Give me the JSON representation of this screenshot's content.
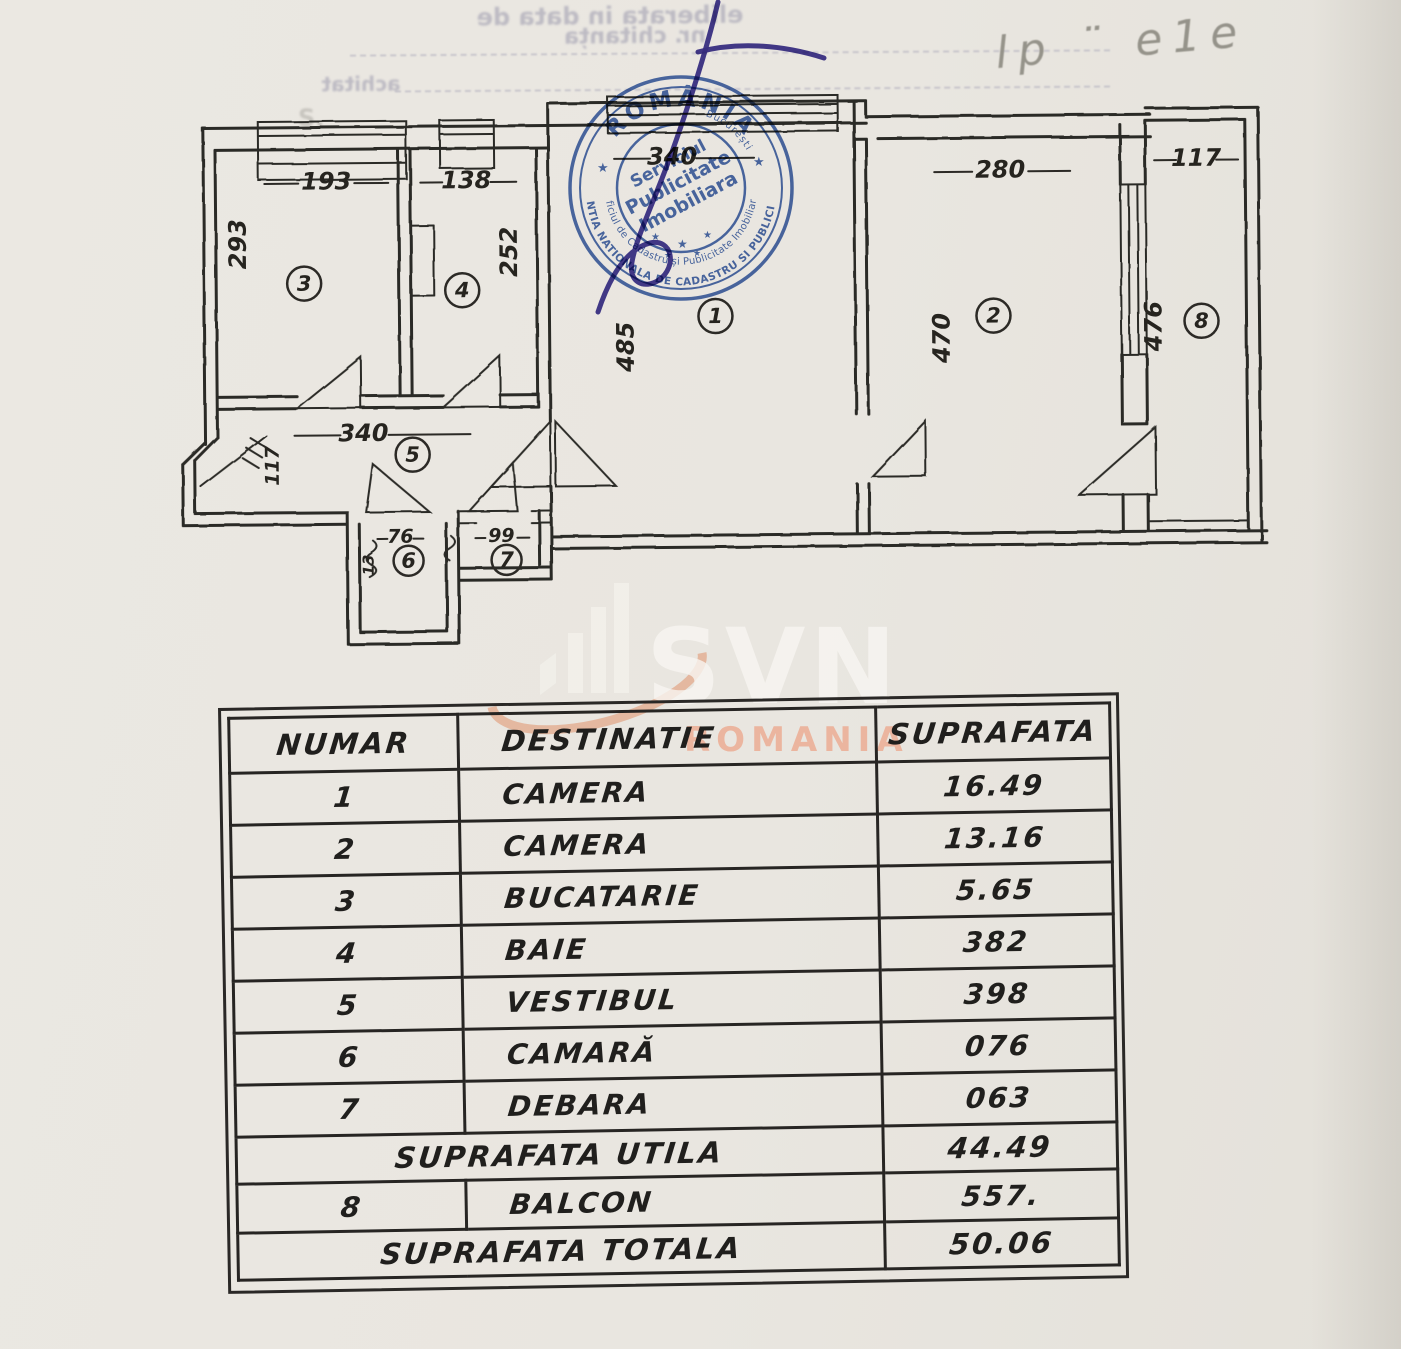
{
  "colors": {
    "paper": "#e9e6e0",
    "ink": "#2c2a26",
    "stamp_blue": "#3f62ab",
    "signature_ink": "#3d3391",
    "watermark_swoosh": "#e08a5f",
    "watermark_region": "#eda184",
    "watermark_brand": "#f8f6f2"
  },
  "bleed": {
    "line1": "eliberata in data de",
    "line2": "nr. chitanța",
    "line3": "achitat",
    "letter": "S."
  },
  "pencil_note": "lp ¨ e1e",
  "stamp": {
    "country": "ROMÂNIA",
    "agency_ring": "AGENTIA NATIONALA DE CADASTRU SI PUBLICITATE",
    "office_ring": "Oficiul de Cadastru și Publicitate Imobiliară",
    "city": "București",
    "center1": "Serviciul",
    "center2": "Publicitate",
    "center3": "Imobiliara",
    "star": "★"
  },
  "watermark": {
    "brand": "SVN",
    "region": "ROMANIA"
  },
  "plan": {
    "dims": {
      "d193": "193",
      "d138": "138",
      "d293": "293",
      "d252": "252",
      "d340_top": "340",
      "d485": "485",
      "d280": "280",
      "d470": "470",
      "d117_balcon": "117",
      "d476": "476",
      "d340_vestibul": "340",
      "d117_intrare": "117",
      "d76": "76",
      "d99": "99",
      "d13": "13"
    },
    "circles": {
      "c1": "1",
      "c2": "2",
      "c3": "3",
      "c4": "4",
      "c5": "5",
      "c6": "6",
      "c7": "7",
      "c8": "8"
    }
  },
  "table": {
    "header": {
      "numar": "NUMAR",
      "destinatie": "DESTINATIE",
      "suprafata": "SUPRAFATA"
    },
    "rows": [
      {
        "num": "1",
        "dest": "CAMERA",
        "sup": "16.49"
      },
      {
        "num": "2",
        "dest": "CAMERA",
        "sup": "13.16"
      },
      {
        "num": "3",
        "dest": "BUCATARIE",
        "sup": "5.65"
      },
      {
        "num": "4",
        "dest": "BAIE",
        "sup": "382"
      },
      {
        "num": "5",
        "dest": "VESTIBUL",
        "sup": "398"
      },
      {
        "num": "6",
        "dest": "CAMARĂ",
        "sup": "076"
      },
      {
        "num": "7",
        "dest": "DEBARA",
        "sup": "063"
      }
    ],
    "utila": {
      "label": "SUPRAFATA UTILA",
      "sup": "44.49"
    },
    "balcon": {
      "num": "8",
      "dest": "BALCON",
      "sup": "557."
    },
    "totala": {
      "label": "SUPRAFATA TOTALA",
      "sup": "50.06"
    }
  }
}
